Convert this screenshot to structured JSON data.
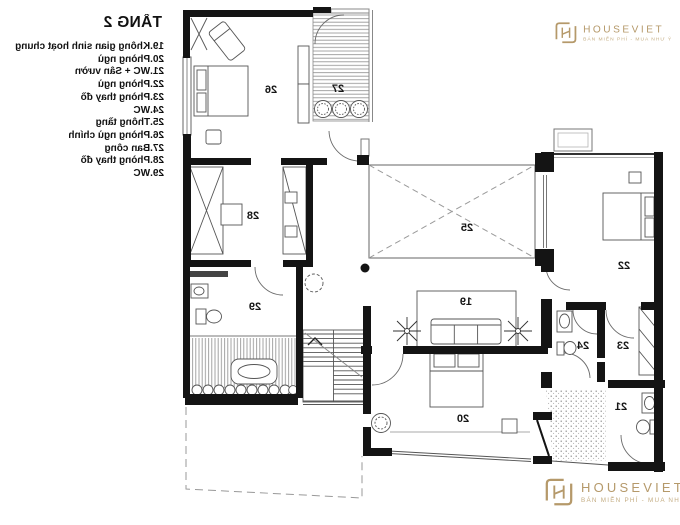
{
  "legend": {
    "title": "TẦNG 2",
    "items": [
      "19.Không gian sinh hoạt chung",
      "20.Phòng ngủ",
      "21.WC + Sân vườn",
      "22.Phòng ngủ",
      "23.Phòng thay đồ",
      "24.WC",
      "25.Thông tầng",
      "26.Phòng ngủ chính",
      "27.Ban công",
      "28.Phòng thay đồ",
      "29.WC"
    ]
  },
  "plan": {
    "rooms": [
      {
        "number": "19"
      },
      {
        "number": "20"
      },
      {
        "number": "21"
      },
      {
        "number": "22"
      },
      {
        "number": "23"
      },
      {
        "number": "24"
      },
      {
        "number": "25"
      },
      {
        "number": "26"
      },
      {
        "number": "27"
      },
      {
        "number": "28"
      },
      {
        "number": "29"
      }
    ]
  },
  "watermark": {
    "brand": "HOUSEVIET",
    "tagline": "BÁN MIỄN PHÍ - MUA NHƯ Ý"
  },
  "colors": {
    "wall": "#141414",
    "thin_line": "#666666",
    "hatch": "#9a9a9a",
    "accent": "#b5996a"
  }
}
